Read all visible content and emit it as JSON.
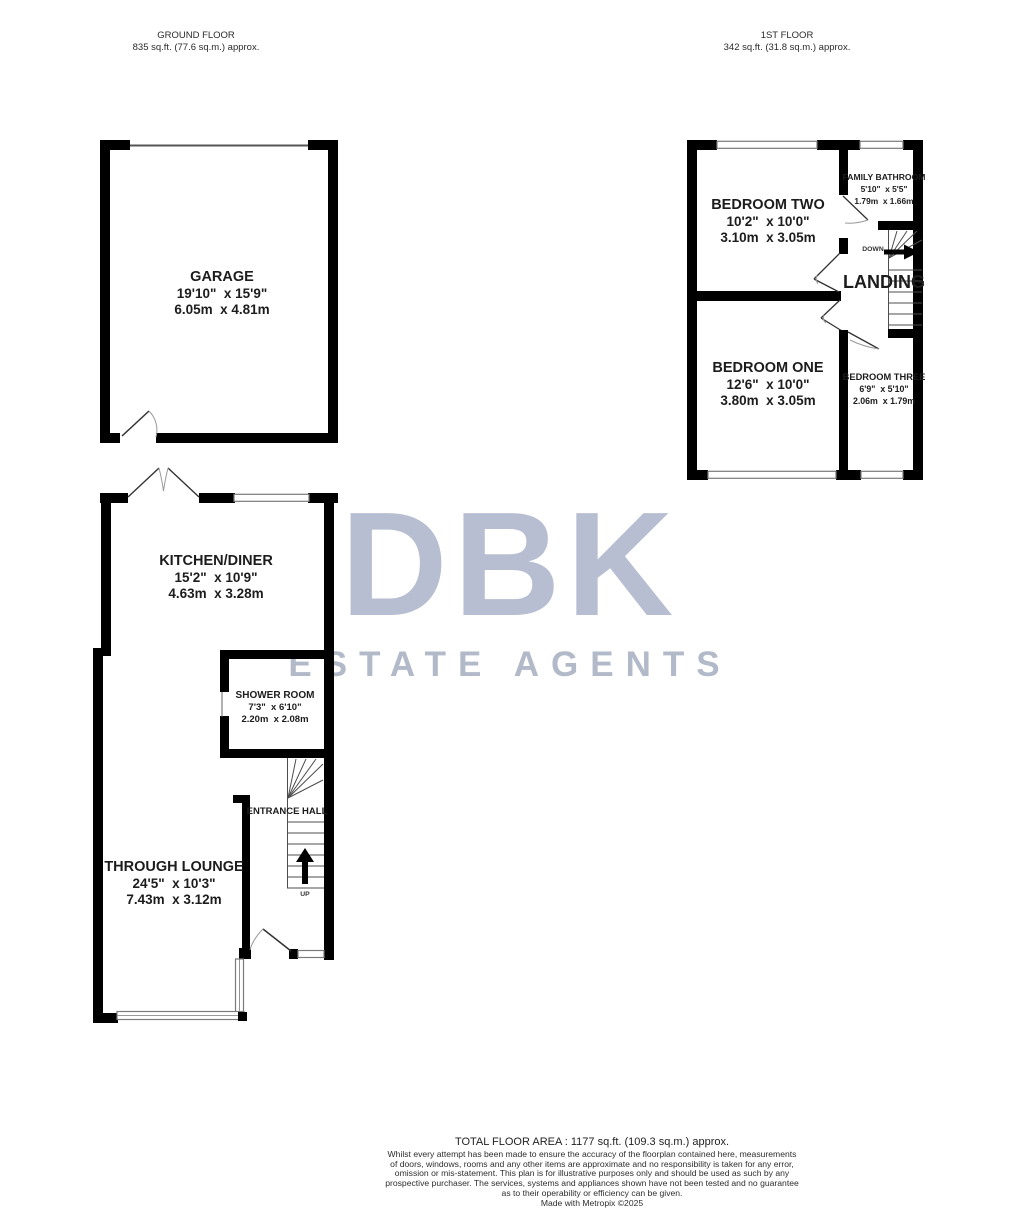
{
  "headers": {
    "ground": {
      "title": "GROUND FLOOR",
      "area": "835 sq.ft. (77.6 sq.m.) approx."
    },
    "first": {
      "title": "1ST FLOOR",
      "area": "342 sq.ft. (31.8 sq.m.) approx."
    }
  },
  "watermark": {
    "brand": "DBK",
    "tagline": "ESTATE AGENTS",
    "brand_color": "#b7bed1",
    "tagline_color": "#b2b9c9"
  },
  "rooms": {
    "garage": {
      "name": "GARAGE",
      "imperial": "19'10\"  x 15'9\"",
      "metric": "6.05m  x 4.81m"
    },
    "kitchen": {
      "name": "KITCHEN/DINER",
      "imperial": "15'2\"  x 10'9\"",
      "metric": "4.63m  x 3.28m"
    },
    "shower": {
      "name": "SHOWER ROOM",
      "imperial": "7'3\"  x 6'10\"",
      "metric": "2.20m  x 2.08m"
    },
    "entrance_hall": {
      "name": "ENTRANCE HALL"
    },
    "lounge": {
      "name": "THROUGH LOUNGE",
      "imperial": "24'5\"  x 10'3\"",
      "metric": "7.43m  x 3.12m"
    },
    "bedroom_two": {
      "name": "BEDROOM TWO",
      "imperial": "10'2\"  x 10'0\"",
      "metric": "3.10m  x 3.05m"
    },
    "bathroom": {
      "name": "FAMILY BATHROOM",
      "imperial": "5'10\"  x 5'5\"",
      "metric": "1.79m  x 1.66m"
    },
    "landing": {
      "name": "LANDING"
    },
    "bedroom_one": {
      "name": "BEDROOM ONE",
      "imperial": "12'6\"  x 10'0\"",
      "metric": "3.80m  x 3.05m"
    },
    "bedroom_three": {
      "name": "BEDROOM THREE",
      "imperial": "6'9\"  x 5'10\"",
      "metric": "2.06m  x 1.79m"
    }
  },
  "stairs": {
    "up": "UP",
    "down": "DOWN"
  },
  "colors": {
    "wall": "#000000",
    "window_frame": "#7a7a7a",
    "door_leaf": "#333333",
    "swing_arc": "#9a9a9a"
  },
  "footer": {
    "total": "TOTAL FLOOR AREA : 1177 sq.ft. (109.3 sq.m.) approx.",
    "disclaimer": [
      "Whilst every attempt has been made to ensure the accuracy of the floorplan contained here, measurements",
      "of doors, windows, rooms and any other items are approximate and no responsibility is taken for any error,",
      "omission or mis-statement. This plan is for illustrative purposes only and should be used as such by any",
      "prospective purchaser. The services, systems and appliances shown have not been tested and no guarantee",
      "as to their operability or efficiency can be given."
    ],
    "credit": "Made with Metropix ©2025"
  }
}
